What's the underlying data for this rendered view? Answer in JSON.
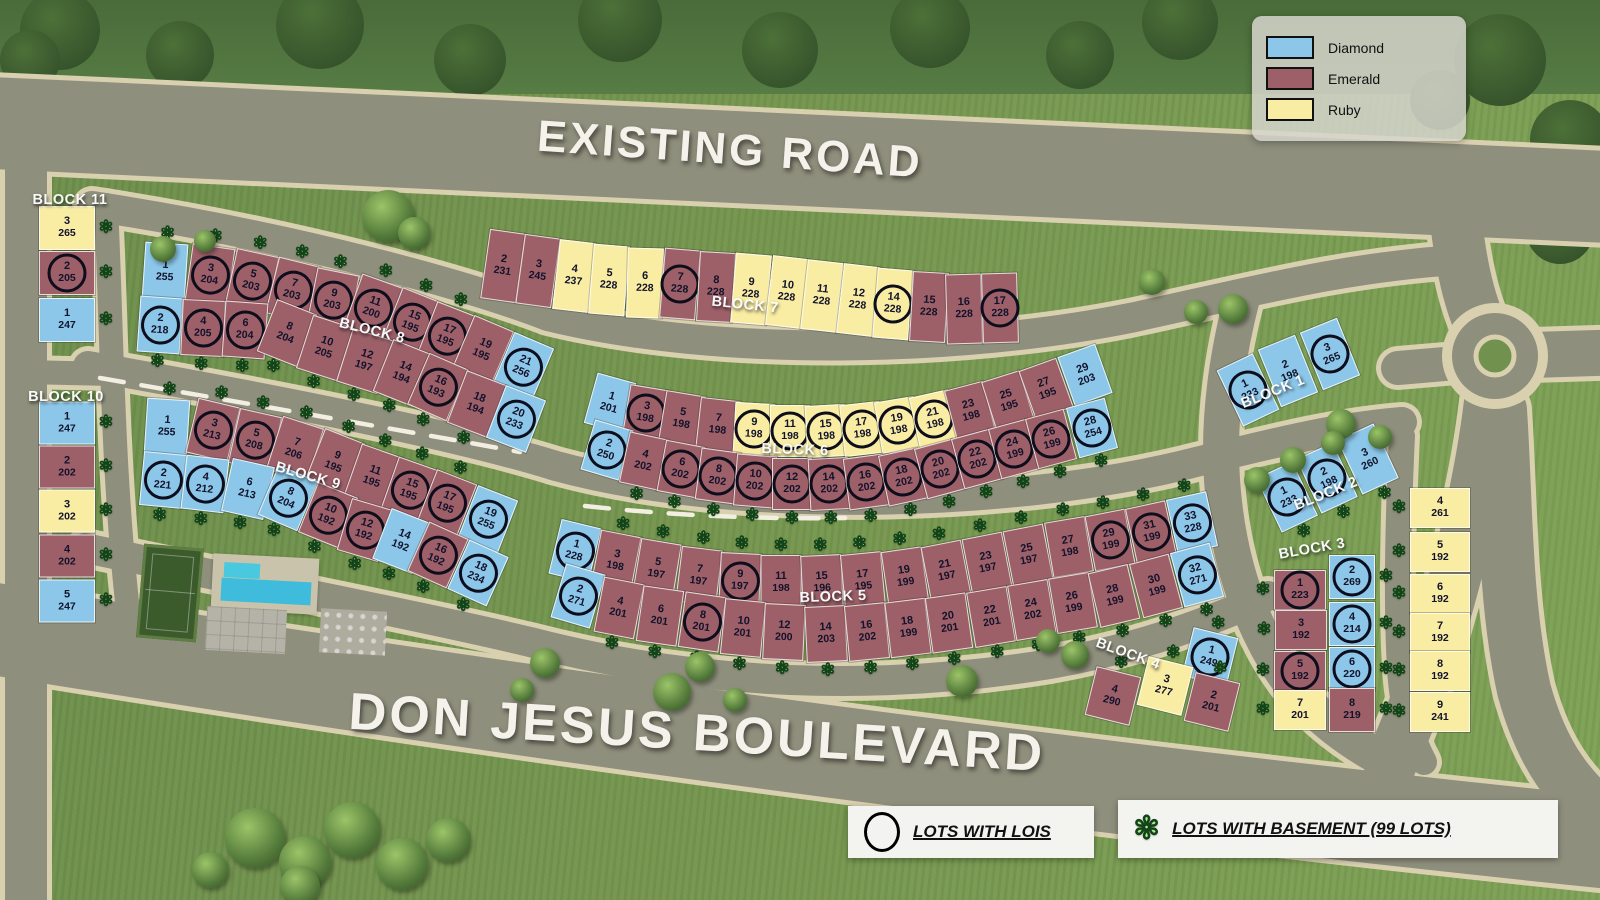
{
  "titles": {
    "existing_road": "EXISTING ROAD",
    "boulevard": "DON JESUS BOULEVARD"
  },
  "legend": {
    "items": [
      {
        "label": "Diamond",
        "color": "#8cc7e9"
      },
      {
        "label": "Emerald",
        "color": "#9d6069"
      },
      {
        "label": "Ruby",
        "color": "#f9eda4"
      }
    ]
  },
  "footer": {
    "lois_label": "LOTS WITH LOIS",
    "basement_label": "LOTS WITH BASEMENT (99 LOTS)"
  },
  "colors": {
    "diamond": "#8cc7e9",
    "emerald": "#9d6069",
    "ruby": "#f9eda4",
    "road": "#8f8f7d",
    "road_edge": "#d9d0b0",
    "grass": "#71914e",
    "basement_icon": "#a9ef86"
  },
  "block_labels": [
    {
      "id": "b11",
      "label": "BLOCK 11"
    },
    {
      "id": "b10",
      "label": "BLOCK 10"
    },
    {
      "id": "b8",
      "label": "BLOCK 8"
    },
    {
      "id": "b7",
      "label": "BLOCK 7"
    },
    {
      "id": "b9",
      "label": "BLOCK 9"
    },
    {
      "id": "b6",
      "label": "BLOCK 6"
    },
    {
      "id": "b5",
      "label": "BLOCK 5"
    },
    {
      "id": "b4",
      "label": "BLOCK 4"
    },
    {
      "id": "b1",
      "label": "BLOCK 1"
    },
    {
      "id": "b2",
      "label": "BLOCK 2"
    },
    {
      "id": "b3",
      "label": "BLOCK 3"
    }
  ],
  "blocks": [
    {
      "id": "b11",
      "lots": [
        {
          "n": 3,
          "a": 265,
          "t": "R",
          "b": true
        },
        {
          "n": 2,
          "a": 205,
          "t": "E",
          "loi": true,
          "b": true
        },
        {
          "n": 1,
          "a": 247,
          "t": "D",
          "b": true
        }
      ]
    },
    {
      "id": "b10",
      "lots": [
        {
          "n": 1,
          "a": 247,
          "t": "D",
          "b": true
        },
        {
          "n": 2,
          "a": 202,
          "t": "E",
          "b": true
        },
        {
          "n": 3,
          "a": 202,
          "t": "R",
          "b": true
        },
        {
          "n": 4,
          "a": 202,
          "t": "E",
          "b": true
        },
        {
          "n": 5,
          "a": 247,
          "t": "D",
          "b": true
        }
      ]
    },
    {
      "id": "b8a",
      "lots": [
        {
          "n": 1,
          "a": 255,
          "t": "D",
          "b": true
        },
        {
          "n": 3,
          "a": 204,
          "t": "E",
          "loi": true,
          "b": true
        },
        {
          "n": 5,
          "a": 203,
          "t": "E",
          "loi": true,
          "b": true
        },
        {
          "n": 7,
          "a": 203,
          "t": "E",
          "loi": true,
          "b": true
        },
        {
          "n": 9,
          "a": 203,
          "t": "E",
          "loi": true,
          "b": true
        },
        {
          "n": 11,
          "a": 200,
          "t": "E",
          "loi": true,
          "b": true
        },
        {
          "n": 15,
          "a": 195,
          "t": "E",
          "loi": true,
          "b": true
        },
        {
          "n": 17,
          "a": 195,
          "t": "E",
          "loi": true,
          "b": true
        },
        {
          "n": 19,
          "a": 195,
          "t": "E"
        },
        {
          "n": 21,
          "a": 256,
          "t": "D",
          "loi": true
        }
      ]
    },
    {
      "id": "b8b",
      "lots": [
        {
          "n": 2,
          "a": 218,
          "t": "D",
          "loi": true,
          "b": true
        },
        {
          "n": 4,
          "a": 205,
          "t": "E",
          "loi": true,
          "b": true
        },
        {
          "n": 6,
          "a": 204,
          "t": "E",
          "loi": true,
          "b": true
        },
        {
          "n": 8,
          "a": 204,
          "t": "E",
          "b": true
        },
        {
          "n": 10,
          "a": 205,
          "t": "E",
          "b": true
        },
        {
          "n": 12,
          "a": 197,
          "t": "E",
          "b": true
        },
        {
          "n": 14,
          "a": 194,
          "t": "E",
          "b": true
        },
        {
          "n": 16,
          "a": 193,
          "t": "E",
          "loi": true,
          "b": true
        },
        {
          "n": 18,
          "a": 194,
          "t": "E",
          "b": true
        },
        {
          "n": 20,
          "a": 233,
          "t": "D",
          "loi": true
        }
      ]
    },
    {
      "id": "b9a",
      "lots": [
        {
          "n": 1,
          "a": 255,
          "t": "D",
          "b": true
        },
        {
          "n": 3,
          "a": 213,
          "t": "E",
          "loi": true,
          "b": true
        },
        {
          "n": 5,
          "a": 208,
          "t": "E",
          "loi": true,
          "b": true
        },
        {
          "n": 7,
          "a": 206,
          "t": "E",
          "b": true
        },
        {
          "n": 9,
          "a": 195,
          "t": "E",
          "b": true
        },
        {
          "n": 11,
          "a": 195,
          "t": "E",
          "b": true
        },
        {
          "n": 15,
          "a": 195,
          "t": "E",
          "loi": true,
          "b": true
        },
        {
          "n": 17,
          "a": 195,
          "t": "E",
          "loi": true,
          "b": true
        },
        {
          "n": 19,
          "a": 255,
          "t": "D",
          "loi": true
        }
      ]
    },
    {
      "id": "b9b",
      "lots": [
        {
          "n": 2,
          "a": 221,
          "t": "D",
          "loi": true,
          "b": true
        },
        {
          "n": 4,
          "a": 212,
          "t": "D",
          "loi": true,
          "b": true
        },
        {
          "n": 6,
          "a": 213,
          "t": "D",
          "b": true
        },
        {
          "n": 8,
          "a": 204,
          "t": "D",
          "loi": true,
          "b": true
        },
        {
          "n": 10,
          "a": 192,
          "t": "E",
          "loi": true,
          "b": true
        },
        {
          "n": 12,
          "a": 192,
          "t": "E",
          "loi": true,
          "b": true
        },
        {
          "n": 14,
          "a": 192,
          "t": "D",
          "b": true
        },
        {
          "n": 16,
          "a": 192,
          "t": "E",
          "loi": true,
          "b": true
        },
        {
          "n": 18,
          "a": 234,
          "t": "D",
          "loi": true,
          "b": true
        }
      ]
    },
    {
      "id": "b7",
      "lots": [
        {
          "n": 2,
          "a": 231,
          "t": "E"
        },
        {
          "n": 3,
          "a": 245,
          "t": "E"
        },
        {
          "n": 4,
          "a": 237,
          "t": "R"
        },
        {
          "n": 5,
          "a": 228,
          "t": "R"
        },
        {
          "n": 6,
          "a": 228,
          "t": "R"
        },
        {
          "n": 7,
          "a": 228,
          "t": "E",
          "loi": true
        },
        {
          "n": 8,
          "a": 228,
          "t": "E"
        },
        {
          "n": 9,
          "a": 228,
          "t": "R"
        },
        {
          "n": 10,
          "a": 228,
          "t": "R"
        },
        {
          "n": 11,
          "a": 228,
          "t": "R"
        },
        {
          "n": 12,
          "a": 228,
          "t": "R"
        },
        {
          "n": 14,
          "a": 228,
          "t": "R",
          "loi": true
        },
        {
          "n": 15,
          "a": 228,
          "t": "E"
        },
        {
          "n": 16,
          "a": 228,
          "t": "E"
        },
        {
          "n": 17,
          "a": 228,
          "t": "E",
          "loi": true
        }
      ]
    },
    {
      "id": "b6a",
      "lots": [
        {
          "n": 1,
          "a": 201,
          "t": "D"
        },
        {
          "n": 3,
          "a": 198,
          "t": "E",
          "loi": true
        },
        {
          "n": 5,
          "a": 198,
          "t": "E"
        },
        {
          "n": 7,
          "a": 198,
          "t": "E"
        },
        {
          "n": 9,
          "a": 198,
          "t": "R",
          "loi": true
        },
        {
          "n": 11,
          "a": 198,
          "t": "R",
          "loi": true
        },
        {
          "n": 15,
          "a": 198,
          "t": "R",
          "loi": true
        },
        {
          "n": 17,
          "a": 198,
          "t": "R",
          "loi": true
        },
        {
          "n": 19,
          "a": 198,
          "t": "R",
          "loi": true
        },
        {
          "n": 21,
          "a": 198,
          "t": "R",
          "loi": true
        },
        {
          "n": 23,
          "a": 198,
          "t": "E"
        },
        {
          "n": 25,
          "a": 195,
          "t": "E"
        },
        {
          "n": 27,
          "a": 195,
          "t": "E"
        },
        {
          "n": 29,
          "a": 203,
          "t": "D"
        }
      ]
    },
    {
      "id": "b6b",
      "lots": [
        {
          "n": 2,
          "a": 250,
          "t": "D",
          "loi": true
        },
        {
          "n": 4,
          "a": 202,
          "t": "E",
          "b": true
        },
        {
          "n": 6,
          "a": 202,
          "t": "E",
          "loi": true,
          "b": true
        },
        {
          "n": 8,
          "a": 202,
          "t": "E",
          "loi": true,
          "b": true
        },
        {
          "n": 10,
          "a": 202,
          "t": "E",
          "loi": true,
          "b": true
        },
        {
          "n": 12,
          "a": 202,
          "t": "E",
          "loi": true,
          "b": true
        },
        {
          "n": 14,
          "a": 202,
          "t": "E",
          "loi": true,
          "b": true
        },
        {
          "n": 16,
          "a": 202,
          "t": "E",
          "loi": true,
          "b": true
        },
        {
          "n": 18,
          "a": 202,
          "t": "E",
          "loi": true,
          "b": true
        },
        {
          "n": 20,
          "a": 202,
          "t": "E",
          "loi": true,
          "b": true
        },
        {
          "n": 22,
          "a": 202,
          "t": "E",
          "loi": true,
          "b": true
        },
        {
          "n": 24,
          "a": 199,
          "t": "E",
          "loi": true,
          "b": true
        },
        {
          "n": 26,
          "a": 199,
          "t": "E",
          "loi": true,
          "b": true
        },
        {
          "n": 28,
          "a": 254,
          "t": "D",
          "loi": true,
          "b": true
        }
      ]
    },
    {
      "id": "b5a",
      "lots": [
        {
          "n": 1,
          "a": 228,
          "t": "D",
          "loi": true
        },
        {
          "n": 3,
          "a": 198,
          "t": "E",
          "b": true
        },
        {
          "n": 5,
          "a": 197,
          "t": "E",
          "b": true
        },
        {
          "n": 7,
          "a": 197,
          "t": "E",
          "b": true
        },
        {
          "n": 9,
          "a": 197,
          "t": "E",
          "loi": true,
          "b": true
        },
        {
          "n": 11,
          "a": 198,
          "t": "E",
          "b": true
        },
        {
          "n": 15,
          "a": 196,
          "t": "E",
          "b": true
        },
        {
          "n": 17,
          "a": 195,
          "t": "E",
          "b": true
        },
        {
          "n": 19,
          "a": 199,
          "t": "E",
          "b": true
        },
        {
          "n": 21,
          "a": 197,
          "t": "E",
          "b": true
        },
        {
          "n": 23,
          "a": 197,
          "t": "E",
          "b": true
        },
        {
          "n": 25,
          "a": 197,
          "t": "E",
          "b": true
        },
        {
          "n": 27,
          "a": 198,
          "t": "E",
          "b": true
        },
        {
          "n": 29,
          "a": 199,
          "t": "E",
          "loi": true,
          "b": true
        },
        {
          "n": 31,
          "a": 199,
          "t": "E",
          "loi": true,
          "b": true
        },
        {
          "n": 33,
          "a": 228,
          "t": "D",
          "loi": true,
          "b": true
        }
      ]
    },
    {
      "id": "b5b",
      "lots": [
        {
          "n": 2,
          "a": 271,
          "t": "D",
          "loi": true
        },
        {
          "n": 4,
          "a": 201,
          "t": "E",
          "b": true
        },
        {
          "n": 6,
          "a": 201,
          "t": "E",
          "b": true
        },
        {
          "n": 8,
          "a": 201,
          "t": "E",
          "loi": true,
          "b": true
        },
        {
          "n": 10,
          "a": 201,
          "t": "E",
          "b": true
        },
        {
          "n": 12,
          "a": 200,
          "t": "E",
          "b": true
        },
        {
          "n": 14,
          "a": 203,
          "t": "E",
          "b": true
        },
        {
          "n": 16,
          "a": 202,
          "t": "E",
          "b": true
        },
        {
          "n": 18,
          "a": 199,
          "t": "E",
          "b": true
        },
        {
          "n": 20,
          "a": 201,
          "t": "E",
          "b": true
        },
        {
          "n": 22,
          "a": 201,
          "t": "E",
          "b": true
        },
        {
          "n": 24,
          "a": 202,
          "t": "E",
          "b": true
        },
        {
          "n": 26,
          "a": 199,
          "t": "E",
          "b": true
        },
        {
          "n": 28,
          "a": 199,
          "t": "E",
          "b": true
        },
        {
          "n": 30,
          "a": 199,
          "t": "E",
          "b": true
        },
        {
          "n": 32,
          "a": 271,
          "t": "D",
          "loi": true,
          "b": true
        }
      ]
    },
    {
      "id": "b4",
      "lots": [
        {
          "n": 1,
          "a": 249,
          "t": "D",
          "loi": true,
          "b": true
        },
        {
          "n": 2,
          "a": 201,
          "t": "E",
          "b": true
        },
        {
          "n": 3,
          "a": 277,
          "t": "R",
          "b": true
        },
        {
          "n": 4,
          "a": 290,
          "t": "E",
          "b": true
        }
      ]
    },
    {
      "id": "b1",
      "lots": [
        {
          "n": 1,
          "a": 233,
          "t": "D",
          "loi": true
        },
        {
          "n": 2,
          "a": 198,
          "t": "D"
        },
        {
          "n": 3,
          "a": 265,
          "t": "D",
          "loi": true
        }
      ]
    },
    {
      "id": "b2",
      "lots": [
        {
          "n": 1,
          "a": 233,
          "t": "D",
          "loi": true,
          "b": true
        },
        {
          "n": 2,
          "a": 198,
          "t": "D",
          "loi": true,
          "b": true
        },
        {
          "n": 3,
          "a": 260,
          "t": "D",
          "b": true
        }
      ]
    },
    {
      "id": "b3a",
      "lots": [
        {
          "n": 1,
          "a": 223,
          "t": "E",
          "loi": true,
          "b": true
        },
        {
          "n": 3,
          "a": 192,
          "t": "E",
          "b": true
        },
        {
          "n": 5,
          "a": 192,
          "t": "E",
          "loi": true,
          "b": true
        },
        {
          "n": 7,
          "a": 201,
          "t": "R",
          "b": true
        }
      ]
    },
    {
      "id": "b3b",
      "lots": [
        {
          "n": 2,
          "a": 269,
          "t": "D",
          "loi": true,
          "b": true
        },
        {
          "n": 4,
          "a": 214,
          "t": "D",
          "loi": true,
          "b": true
        },
        {
          "n": 6,
          "a": 220,
          "t": "D",
          "loi": true,
          "b": true
        },
        {
          "n": 8,
          "a": 219,
          "t": "E",
          "b": true
        }
      ]
    },
    {
      "id": "b3c",
      "lots": [
        {
          "n": 4,
          "a": 261,
          "t": "R",
          "b": true
        },
        {
          "n": 5,
          "a": 192,
          "t": "R",
          "b": true
        },
        {
          "n": 6,
          "a": 192,
          "t": "R",
          "b": true
        },
        {
          "n": 7,
          "a": 192,
          "t": "R",
          "b": true
        },
        {
          "n": 8,
          "a": 192,
          "t": "R",
          "b": true
        },
        {
          "n": 9,
          "a": 241,
          "t": "R",
          "b": true
        }
      ]
    }
  ]
}
